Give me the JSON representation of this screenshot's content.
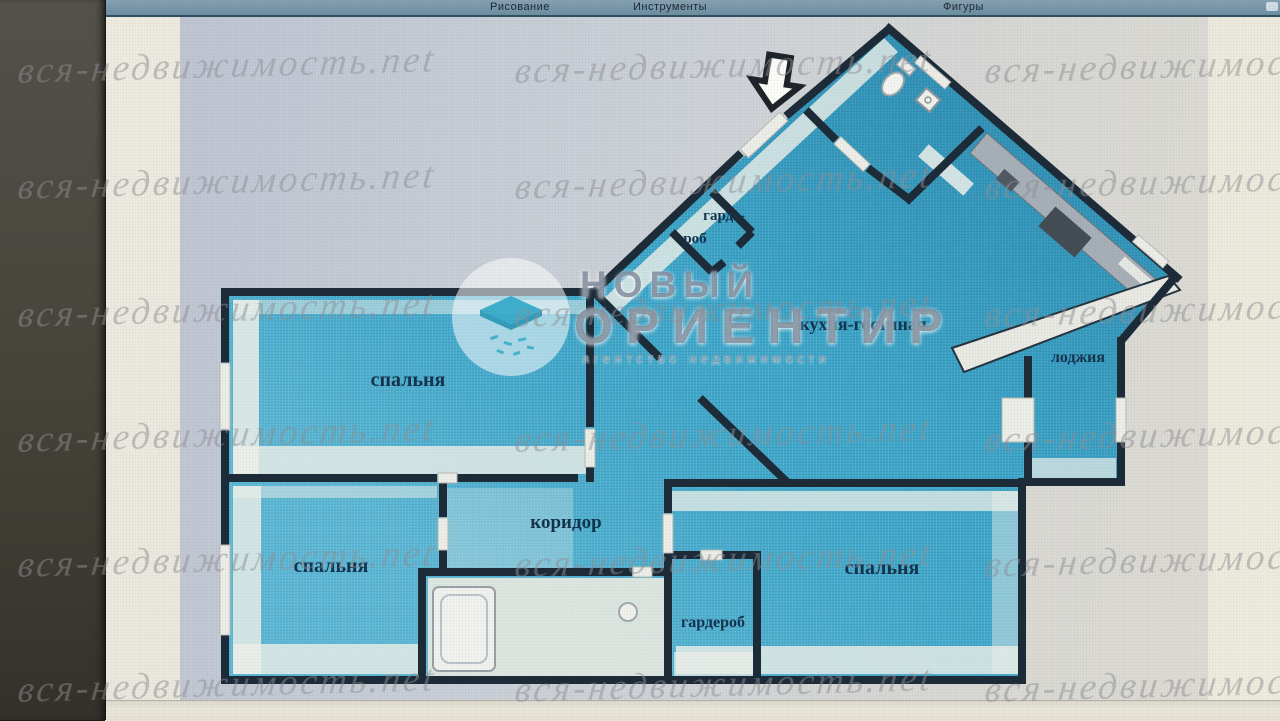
{
  "toolbar": {
    "items": [
      {
        "label": "Рисование"
      },
      {
        "label": "Инструменты"
      },
      {
        "label": "Фигуры"
      }
    ]
  },
  "watermark": {
    "text": "вся-недвижимость.net"
  },
  "logo": {
    "line1": "НОВЫЙ",
    "line2": "ОРИЕНТИР",
    "tagline": "агентство недвижимости"
  },
  "rooms": {
    "bedroom_top_left": "спальня",
    "bedroom_bottom_left": "спальня",
    "bedroom_bottom_right": "спальня",
    "kitchen_living": "кухня-гостиная",
    "loggia": "лоджия",
    "corridor": "коридор",
    "wardrobe": "гардероб",
    "closet_line1": "гарде-",
    "closet_line2": "роб"
  },
  "colors": {
    "floor_blue": "#3fadd0",
    "wall_dark": "#1d2c38",
    "panel_gray": "#c7cdd6",
    "toolbar_teal": "#7a99ab",
    "screen_cream": "#eae7dd"
  }
}
